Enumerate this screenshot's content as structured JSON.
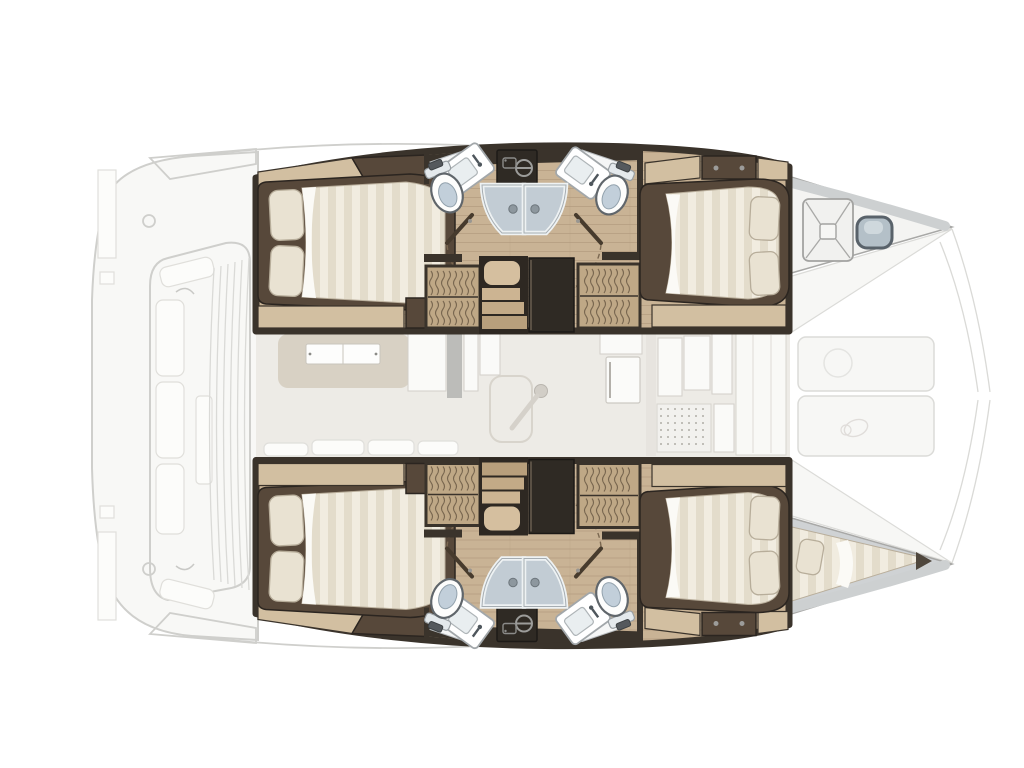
{
  "floorplan": {
    "vessel": "catamaran",
    "view": "overhead-interior-layout",
    "orientation": "bow-right-stern-left",
    "hulls": [
      {
        "id": "upper-hull",
        "rooms": [
          {
            "name": "double-cabin-aft",
            "fixtures": [
              "double-bed",
              "two-pillows",
              "headboard-shelf",
              "side-locker"
            ]
          },
          {
            "name": "head-aft",
            "fixtures": [
              "toilet",
              "washbasin",
              "vanity-counter",
              "dark-cabinet"
            ]
          },
          {
            "name": "shared-shower",
            "fixtures": [
              "shower-door-left",
              "shower-door-right"
            ]
          },
          {
            "name": "companionway",
            "fixtures": [
              "stairs-landing",
              "three-steps",
              "tall-dark-locker"
            ]
          },
          {
            "name": "hanging-lockers",
            "fixtures": [
              "hanging-rail-left",
              "hanging-rail-right"
            ]
          },
          {
            "name": "head-forward",
            "fixtures": [
              "toilet",
              "washbasin",
              "vanity-counter",
              "galley-counter-dark"
            ]
          },
          {
            "name": "double-cabin-forward",
            "fixtures": [
              "double-bed",
              "two-pillows",
              "foot-shelf"
            ]
          },
          {
            "name": "bow-compartment",
            "fixtures": [
              "cross-braced-deck-hatch",
              "bow-fitting"
            ]
          }
        ]
      },
      {
        "id": "lower-hull",
        "mirror_of": "upper-hull",
        "rooms": [
          {
            "name": "double-cabin-aft"
          },
          {
            "name": "head-aft"
          },
          {
            "name": "shared-shower"
          },
          {
            "name": "companionway"
          },
          {
            "name": "hanging-lockers"
          },
          {
            "name": "head-forward"
          },
          {
            "name": "double-cabin-forward"
          },
          {
            "name": "bow-single-berth",
            "fixtures": [
              "single-mattress",
              "pillow"
            ]
          }
        ]
      }
    ],
    "bridgedeck": {
      "rooms": [
        {
          "name": "saloon",
          "fixtures": [
            "dinette-sofa",
            "saloon-table",
            "sofa-cushions",
            "cabinet-column",
            "table-pedestal"
          ]
        },
        {
          "name": "galley",
          "fixtures": [
            "fridge",
            "counter-units",
            "floor-grate"
          ]
        },
        {
          "name": "forward-deck",
          "fixtures": [
            "seat-pad-upper",
            "seat-pad-lower"
          ]
        }
      ]
    },
    "aft_deck": {
      "rooms": [
        {
          "name": "aft-cockpit-ghost",
          "fixtures": [
            "bench-cushions",
            "cockpit-table",
            "transom-steps",
            "sliding-door-blinds"
          ]
        }
      ]
    },
    "fixture_counts": {
      "double_beds": 4,
      "single_berths": 1,
      "toilets": 4,
      "washbasins": 4,
      "shower_doors": 4,
      "stairs": 2,
      "deck_hatches": 1
    }
  },
  "colors": {
    "page_bg": "#ffffff",
    "wood": "#c9b395",
    "wood_line": "#a78f70",
    "wood_light": "#d2bfa1",
    "wall_dark": "#3a332b",
    "frame_dark": "#57483a",
    "mattress": "#f1ece0",
    "mattress_stripe": "#e3dccb",
    "pillow": "#e9e2d2",
    "pillow_edge": "#b7ad9a",
    "shower_glass": "#c2ccd4",
    "toilet_bowl": "#c2cfda",
    "cabinet_dark": "#2f2a24",
    "locker_bg": "#bfa886",
    "locker_line": "#6b5b45",
    "stair_wood": "#ccb492",
    "swing_dash": "#7a6750",
    "saloon_bg": "#edebe6",
    "dinette_base": "#d8d1c4",
    "ghost_stroke": "#cfcfcc",
    "ghost_fill": "#f8f8f6",
    "bow_deck": "#f4f4f2",
    "bow_band": "#cdd0d1",
    "berth_deck": "#cfd2d4",
    "tip_dark": "#4f473d",
    "metal": "#9c9c9a"
  }
}
